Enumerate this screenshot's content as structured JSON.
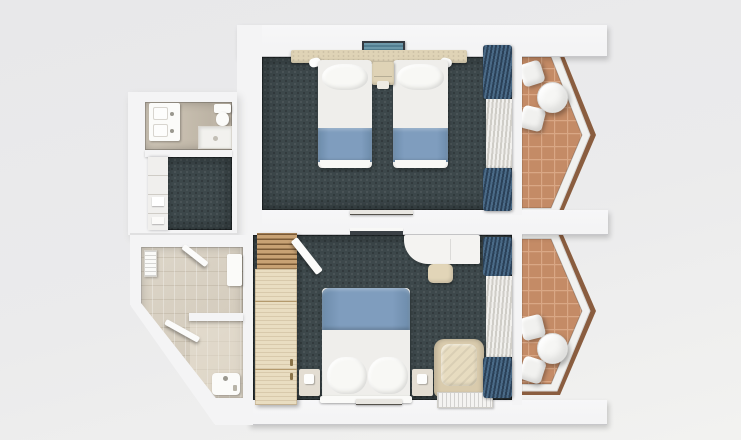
{
  "scene": {
    "type": "3d-floor-plan-top-down-render",
    "subject": "two-hotel-guest-rooms-with-pointed-balconies"
  },
  "palette": {
    "bg_top": "#e8e8ea",
    "bg_mid": "#ebebec",
    "bg_bottom": "#f2f2f0",
    "wall": "#f4f4f5",
    "band_edge": "#c7c7ca",
    "carpet": "#3d484b",
    "curtain_navy_dark": "#2b4158",
    "curtain_navy_light": "#4a6a87",
    "sheer_light": "#f1f0ed",
    "sheer_dark": "#cfcdc7",
    "bed_white": "#efeeeb",
    "pillow_white": "#f8f8f5",
    "bed_runner_blue": "#7f9dbe",
    "wood_beige": "#dfd3b6",
    "wood_light": "#e9ddc1",
    "slat_light": "#c8a274",
    "slat_dark": "#7a5a36",
    "balcony_tile": "#c48b66",
    "balcony_tile_line": "#d9a785",
    "balcony_rim": "#8a5d3f",
    "railing": "#f1f1ef",
    "bath_tile_warm": "#c6bdae",
    "bath_tile_light": "#d7cfc1",
    "armchair": "#d9cbad",
    "armchair_cushion": "#e7dcc0",
    "ac_frame": "#353b42",
    "ac_vent_light": "#6d98a9",
    "ac_vent_dark": "#527e91",
    "white_furniture": "#f4f3f1"
  },
  "units": [
    {
      "name": "upper-guest-room",
      "spaces": [
        {
          "name": "twin-bedroom",
          "items": [
            "headboard-panel",
            "air-conditioner",
            "twin-bed-left",
            "twin-bed-right",
            "bedside-table",
            "reading-lamp-left",
            "reading-lamp-right",
            "wall-console",
            "navy-curtain",
            "sheer-curtain"
          ]
        },
        {
          "name": "entry-hall",
          "items": [
            "open-shelf-closet",
            "carpet"
          ]
        },
        {
          "name": "bathroom",
          "items": [
            "double-washbasin-vanity",
            "toilet",
            "shower-tray"
          ]
        },
        {
          "name": "balcony",
          "items": [
            "round-table",
            "chair",
            "chair",
            "pointed-railing",
            "terracotta-tiles"
          ]
        }
      ]
    },
    {
      "name": "lower-guest-room",
      "spaces": [
        {
          "name": "double-bedroom",
          "items": [
            "double-bed",
            "bedside-table-left",
            "bedside-table-right",
            "wardrobe",
            "luggage-rack",
            "open-door",
            "desk",
            "stool",
            "armchair",
            "convector-grille",
            "wall-tv-shelf",
            "navy-curtain",
            "sheer-curtain"
          ]
        },
        {
          "name": "bathroom",
          "items": [
            "towel-radiator",
            "wall-cabinet",
            "partition-wall",
            "washbasin",
            "shower-door"
          ]
        },
        {
          "name": "balcony",
          "items": [
            "round-table",
            "chair",
            "chair",
            "pointed-railing",
            "terracotta-tiles"
          ]
        }
      ]
    }
  ]
}
